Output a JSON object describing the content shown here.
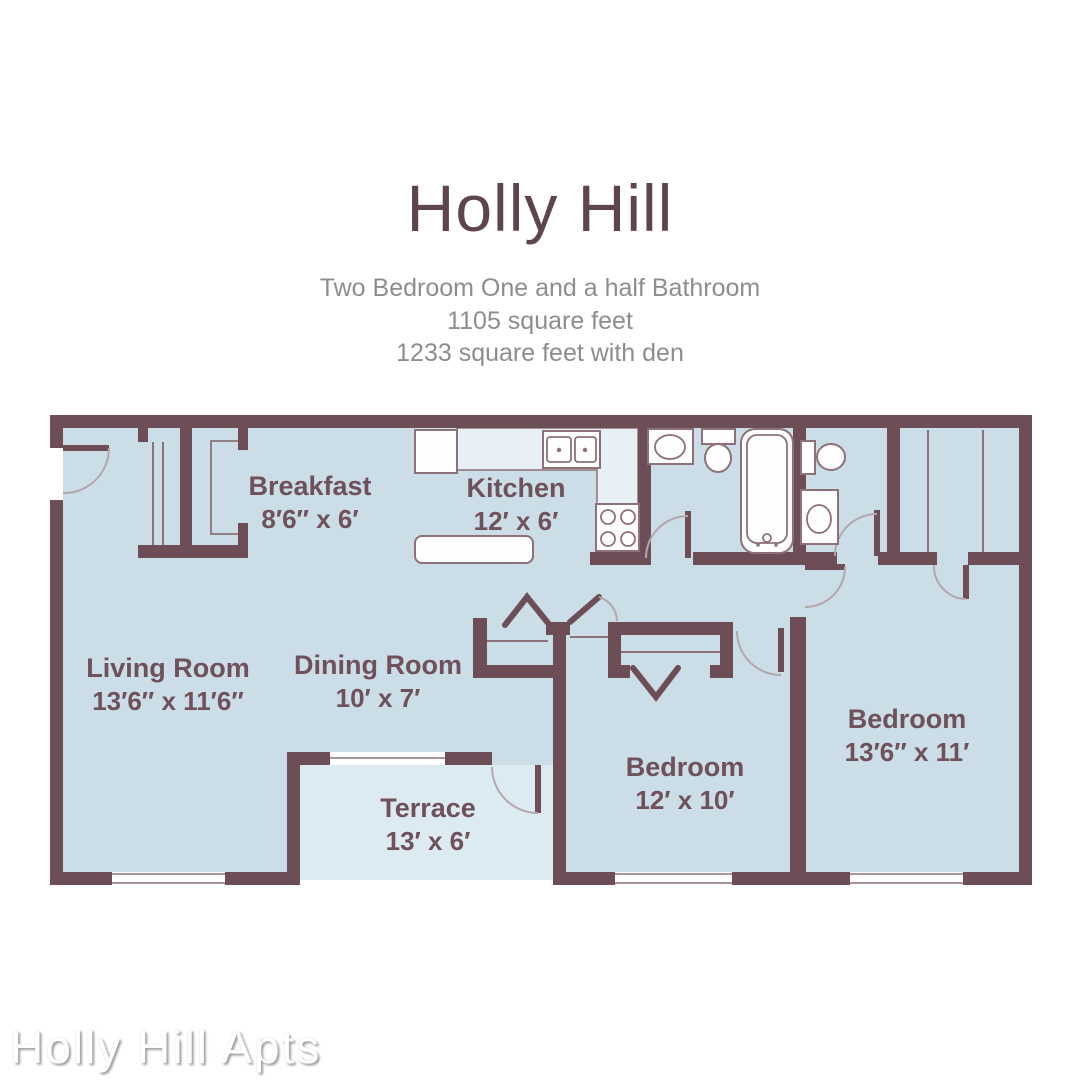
{
  "header": {
    "title": "Holly Hill",
    "subtitle_lines": [
      "Two Bedroom One and a half Bathroom",
      "1105 square feet",
      "1233 square feet with den"
    ]
  },
  "floorplan": {
    "rooms": [
      {
        "name": "Breakfast",
        "dimensions": "8′6″ x 6′"
      },
      {
        "name": "Kitchen",
        "dimensions": "12′ x 6′"
      },
      {
        "name": "Living Room",
        "dimensions": "13′6″ x 11′6″"
      },
      {
        "name": "Dining Room",
        "dimensions": "10′ x 7′"
      },
      {
        "name": "Terrace",
        "dimensions": "13′ x 6′"
      },
      {
        "name": "Bedroom",
        "dimensions": "12′ x 10′"
      },
      {
        "name": "Bedroom",
        "dimensions": "13′6″ x 11′"
      }
    ],
    "fixtures": [
      "refrigerator",
      "kitchen-counter",
      "double-sink",
      "range",
      "kitchen-island",
      "bathroom-vanity",
      "toilet",
      "bathtub",
      "half-bath-toilet",
      "washer",
      "closet-rods",
      "bifold-doors",
      "wardrobe-dividers"
    ],
    "colors": {
      "wall": "#6d4e57",
      "interior": "#cbdde7",
      "terrace": "#dcebf2",
      "fixture_fill": "#fefefe",
      "fixture_outline": "#8d7078",
      "counter_fill": "#e7f0f5",
      "door_arc": "#b3a6ac",
      "title_text": "#5e454c",
      "subtitle_text": "#8d8d8f",
      "label_text": "#6f515b",
      "watermark_text": "#ffffff"
    }
  },
  "watermark": {
    "text": "Holly Hill Apts"
  }
}
